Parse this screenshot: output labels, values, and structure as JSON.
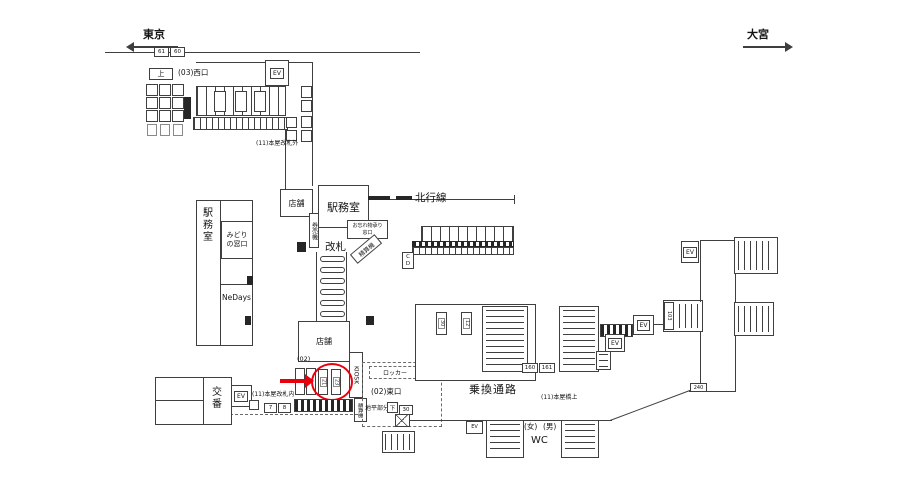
{
  "colors": {
    "accent": "#e8000d",
    "line": "#3f3f3f",
    "background": "#ffffff"
  },
  "directions": {
    "tokyo": "東京",
    "omiya": "大宮"
  },
  "top_area": {
    "track_no_a": "61",
    "track_no_b": "60",
    "west_exit": "(03)西口",
    "up": "上",
    "ev": "EV",
    "outside_gate": "(11)本屋改札外"
  },
  "left_block": {
    "station_office": "駅務室",
    "midori_window": "みどり\nの窓口",
    "nedays": "NeDays"
  },
  "concourse": {
    "shop_top": "店舗",
    "station_office": "駅務室",
    "ticket_machines": "券売機",
    "gate": "改札",
    "lost_and_found": "お忘れ物承り\n窓口",
    "fare_adjust": "精算機",
    "north_line": "北行線",
    "cd": "C\nD",
    "inside_gate": "(11)本屋改札内"
  },
  "south_area": {
    "shop": "店舗",
    "kiosk": "KIOSK",
    "code_02": "(02)",
    "ev": "EV",
    "machine_7": "7",
    "machine_8": "8",
    "circled_a": "21",
    "circled_b": "23",
    "fare_adjust": "精算機",
    "koban": "交番"
  },
  "east_exit": {
    "locker": "ロッカー",
    "name": "(02)東口",
    "ground": "地平部分",
    "down": "下",
    "no_30": "30"
  },
  "transfer": {
    "name": "乗換通路",
    "bridge": "(11)本屋橋上",
    "no_160": "160",
    "no_161": "161",
    "no_103": "103",
    "no_240": "240",
    "ev": "EV",
    "machine_a": "30",
    "machine_b": "12"
  },
  "wc_area": {
    "ev": "EV",
    "women": "(女)",
    "men": "(男)",
    "name": "WC"
  }
}
